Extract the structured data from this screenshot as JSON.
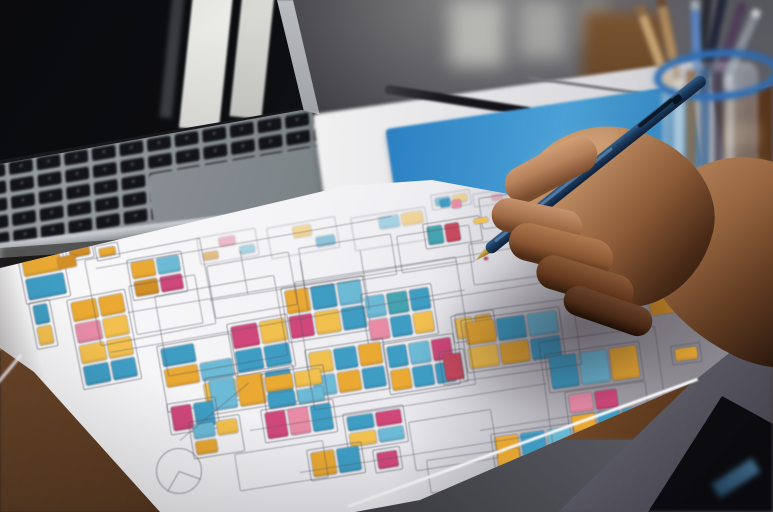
{
  "scene": {
    "description": "Photograph: a designer's hand holding a navy pen, sketching colorful app wireframes on a large paper sheet; laptop, white notepad with black pen, blue notebook and a glass cup of pencils on a wooden desk; blurred dark wall with window light behind",
    "objects": [
      "laptop",
      "keyboard",
      "trackpad",
      "white-notepad",
      "black-pen",
      "blue-notebook",
      "pencil-cup",
      "colored-pencils",
      "wireframe-paper",
      "hand",
      "navy-pen",
      "wooden-desk"
    ]
  },
  "palette": {
    "y1": "#e9a933",
    "y2": "#f2c04e",
    "y3": "#d28f26",
    "b1": "#3f9dc4",
    "b2": "#6cbad6",
    "b3": "#2d84a8",
    "p1": "#d0487a",
    "p2": "#e78ba6",
    "p3": "#c84a5f",
    "t1": "#45a4b0",
    "w": "transparent",
    "accent_notebook": "#3a8fc9",
    "accent_cup_rim": "#2f6fb5",
    "pen_navy": "#1e3e62",
    "pen_gold": "#c9a23f",
    "paper": "#f2f2f5"
  },
  "laptop": {
    "key_rows": 5,
    "key_cols": 14
  },
  "cards": [
    {
      "x": 16,
      "y": 252,
      "w": 46,
      "h": 54,
      "rot": -11,
      "rows": [
        [
          "y1"
        ],
        [
          "b1"
        ]
      ]
    },
    {
      "x": 64,
      "y": 245,
      "w": 28,
      "h": 18,
      "rot": -11,
      "rows": [
        [
          "y3"
        ]
      ]
    },
    {
      "x": 94,
      "y": 246,
      "w": 24,
      "h": 16,
      "rot": -11,
      "rows": [
        [
          "y1"
        ]
      ]
    },
    {
      "x": 28,
      "y": 303,
      "w": 22,
      "h": 48,
      "rot": -11,
      "rows": [
        [
          "b1"
        ],
        [
          "y2"
        ]
      ]
    },
    {
      "x": 66,
      "y": 300,
      "w": 60,
      "h": 92,
      "rot": -11,
      "rows": [
        [
          "y1",
          "y1"
        ],
        [
          "p2",
          "y2"
        ],
        [
          "y2",
          "y2"
        ],
        [
          "b1",
          "b1"
        ]
      ]
    },
    {
      "x": 126,
      "y": 260,
      "w": 56,
      "h": 42,
      "rot": -10,
      "rows": [
        [
          "y1",
          "b2"
        ],
        [
          "y3",
          "p1"
        ]
      ]
    },
    {
      "x": 156,
      "y": 346,
      "w": 76,
      "h": 68,
      "rot": -10,
      "rows": [
        [
          "b1",
          "w"
        ],
        [
          "y1",
          "b2"
        ],
        [
          "w",
          "y2"
        ]
      ]
    },
    {
      "x": 226,
      "y": 324,
      "w": 62,
      "h": 54,
      "rot": -10,
      "rows": [
        [
          "p1",
          "y2"
        ],
        [
          "b1",
          "b1"
        ]
      ]
    },
    {
      "x": 280,
      "y": 288,
      "w": 84,
      "h": 56,
      "rot": -9,
      "rows": [
        [
          "y1",
          "b1",
          "b2"
        ],
        [
          "p1",
          "y2",
          "b1"
        ]
      ]
    },
    {
      "x": 360,
      "y": 294,
      "w": 72,
      "h": 52,
      "rot": -9,
      "rows": [
        [
          "b2",
          "t1",
          "b1"
        ],
        [
          "p2",
          "b1",
          "y2"
        ]
      ]
    },
    {
      "x": 304,
      "y": 350,
      "w": 80,
      "h": 52,
      "rot": -9,
      "rows": [
        [
          "y2",
          "b1",
          "y1"
        ],
        [
          "b2",
          "y1",
          "b1"
        ]
      ]
    },
    {
      "x": 382,
      "y": 344,
      "w": 72,
      "h": 52,
      "rot": -9,
      "rows": [
        [
          "b1",
          "b2",
          "p1"
        ],
        [
          "y1",
          "b1",
          "b1"
        ]
      ]
    },
    {
      "x": 438,
      "y": 352,
      "w": 26,
      "h": 34,
      "rot": -9,
      "rows": [
        [
          "p3"
        ]
      ]
    },
    {
      "x": 450,
      "y": 316,
      "w": 44,
      "h": 28,
      "rot": -9,
      "rows": [
        [
          "y2",
          "y1"
        ]
      ]
    },
    {
      "x": 422,
      "y": 224,
      "w": 58,
      "h": 26,
      "rot": -9,
      "rows": [
        [
          "t1",
          "p3",
          "w"
        ]
      ]
    },
    {
      "x": 204,
      "y": 378,
      "w": 90,
      "h": 38,
      "rot": -9,
      "rows": [
        [
          "b2",
          "y1",
          "b1"
        ]
      ]
    },
    {
      "x": 166,
      "y": 404,
      "w": 50,
      "h": 32,
      "rot": -9,
      "rows": [
        [
          "p1",
          "b1"
        ]
      ]
    },
    {
      "x": 188,
      "y": 422,
      "w": 52,
      "h": 38,
      "rot": -9,
      "rows": [
        [
          "b2",
          "y2"
        ],
        [
          "y1",
          "w"
        ]
      ]
    },
    {
      "x": 260,
      "y": 374,
      "w": 64,
      "h": 40,
      "rot": -9,
      "rows": [
        [
          "y1",
          "y2"
        ],
        [
          "b1",
          "b2"
        ]
      ]
    },
    {
      "x": 260,
      "y": 410,
      "w": 74,
      "h": 34,
      "rot": -9,
      "rows": [
        [
          "p1",
          "p2",
          "b1"
        ]
      ]
    },
    {
      "x": 342,
      "y": 414,
      "w": 62,
      "h": 38,
      "rot": -9,
      "rows": [
        [
          "b1",
          "p1"
        ],
        [
          "y2",
          "b2"
        ]
      ]
    },
    {
      "x": 306,
      "y": 450,
      "w": 56,
      "h": 32,
      "rot": -9,
      "rows": [
        [
          "y1",
          "b1"
        ]
      ]
    },
    {
      "x": 372,
      "y": 450,
      "w": 28,
      "h": 24,
      "rot": -9,
      "rows": [
        [
          "p1"
        ]
      ]
    },
    {
      "x": 460,
      "y": 320,
      "w": 100,
      "h": 54,
      "rot": -8,
      "rows": [
        [
          "y1",
          "b1",
          "b2"
        ],
        [
          "y2",
          "y1",
          "b1"
        ]
      ]
    },
    {
      "x": 544,
      "y": 354,
      "w": 96,
      "h": 40,
      "rot": -8,
      "rows": [
        [
          "b1",
          "b2",
          "y1"
        ]
      ]
    },
    {
      "x": 564,
      "y": 392,
      "w": 82,
      "h": 46,
      "rot": -8,
      "rows": [
        [
          "p2",
          "p1",
          "w"
        ],
        [
          "y1",
          "b1",
          "b1"
        ]
      ]
    },
    {
      "x": 490,
      "y": 434,
      "w": 84,
      "h": 38,
      "rot": -8,
      "rows": [
        [
          "y1",
          "b1",
          "b2"
        ]
      ]
    },
    {
      "x": 670,
      "y": 346,
      "w": 30,
      "h": 20,
      "rot": -8,
      "rows": [
        [
          "y1"
        ]
      ]
    },
    {
      "x": 196,
      "y": 238,
      "w": 60,
      "h": 28,
      "rot": -10,
      "faint": true,
      "rows": [
        [
          "w",
          "p2",
          "w"
        ],
        [
          "y3",
          "w",
          "b2"
        ]
      ]
    },
    {
      "x": 266,
      "y": 228,
      "w": 70,
      "h": 32,
      "rot": -10,
      "faint": true,
      "rows": [
        [
          "w",
          "y2",
          "w"
        ],
        [
          "w",
          "w",
          "b1"
        ]
      ]
    },
    {
      "x": 350,
      "y": 218,
      "w": 76,
      "h": 34,
      "rot": -9,
      "faint": true,
      "rows": [
        [
          "w",
          "b2",
          "y2"
        ],
        [
          "w",
          "w",
          "w"
        ]
      ]
    },
    {
      "x": 430,
      "y": 195,
      "w": 40,
      "h": 16,
      "rot": -9,
      "faint": true,
      "rows": [
        [
          "b1",
          "y2"
        ]
      ]
    },
    {
      "x": 472,
      "y": 194,
      "w": 34,
      "h": 14,
      "rot": -9,
      "faint": true,
      "rows": [
        [
          "w",
          "p2"
        ]
      ]
    },
    {
      "x": 506,
      "y": 220,
      "w": 58,
      "h": 28,
      "rot": -8,
      "faint": true,
      "rows": [
        [
          "w",
          "b2",
          "w"
        ]
      ]
    },
    {
      "x": 558,
      "y": 258,
      "w": 68,
      "h": 34,
      "rot": -8,
      "faint": true,
      "rows": [
        [
          "w",
          "y2",
          "b1"
        ]
      ]
    }
  ],
  "blocks": [
    {
      "x": 440,
      "y": 199,
      "w": 10,
      "h": 8,
      "rot": -9,
      "c": "b1"
    },
    {
      "x": 452,
      "y": 200,
      "w": 9,
      "h": 8,
      "rot": -9,
      "c": "p2"
    },
    {
      "x": 474,
      "y": 218,
      "w": 14,
      "h": 5,
      "rot": -9,
      "c": "y2"
    },
    {
      "x": 484,
      "y": 257,
      "w": 4,
      "h": 3,
      "rot": 0,
      "c": "p3"
    },
    {
      "x": 58,
      "y": 256,
      "w": 18,
      "h": 12,
      "rot": -11,
      "c": "y3"
    },
    {
      "x": 650,
      "y": 298,
      "w": 24,
      "h": 16,
      "rot": -8,
      "c": "y3"
    }
  ],
  "outlines": [
    {
      "x": 128,
      "y": 286,
      "w": 68,
      "h": 50,
      "rot": -10
    },
    {
      "x": 206,
      "y": 266,
      "w": 84,
      "h": 54,
      "rot": -10
    },
    {
      "x": 298,
      "y": 248,
      "w": 94,
      "h": 42,
      "rot": -9
    },
    {
      "x": 396,
      "y": 236,
      "w": 74,
      "h": 38,
      "rot": -9
    },
    {
      "x": 468,
      "y": 244,
      "w": 82,
      "h": 42,
      "rot": -8
    },
    {
      "x": 154,
      "y": 296,
      "w": 122,
      "h": 82,
      "rot": -10
    },
    {
      "x": 294,
      "y": 282,
      "w": 164,
      "h": 130,
      "rot": -9
    },
    {
      "x": 454,
      "y": 314,
      "w": 120,
      "h": 68,
      "rot": -8
    },
    {
      "x": 408,
      "y": 422,
      "w": 84,
      "h": 50,
      "rot": -9
    },
    {
      "x": 234,
      "y": 454,
      "w": 90,
      "h": 38,
      "rot": -9
    },
    {
      "x": 426,
      "y": 460,
      "w": 94,
      "h": 34,
      "rot": -8
    },
    {
      "x": 84,
      "y": 260,
      "w": 118,
      "h": 88,
      "rot": -11
    },
    {
      "x": 538,
      "y": 342,
      "w": 118,
      "h": 106,
      "rot": -8
    },
    {
      "x": 478,
      "y": 198,
      "w": 58,
      "h": 32,
      "rot": -8
    },
    {
      "x": 520,
      "y": 470,
      "w": 84,
      "h": 28,
      "rot": -8
    }
  ],
  "lines": [
    {
      "x": 96,
      "y": 268,
      "len": 300,
      "rot": -10
    },
    {
      "x": 128,
      "y": 312,
      "len": 420,
      "rot": -9.5
    },
    {
      "x": 110,
      "y": 352,
      "len": 360,
      "rot": -10
    },
    {
      "x": 210,
      "y": 300,
      "len": 250,
      "rot": -9
    },
    {
      "x": 250,
      "y": 430,
      "len": 300,
      "rot": -9
    },
    {
      "x": 300,
      "y": 472,
      "len": 260,
      "rot": -9
    },
    {
      "x": 430,
      "y": 300,
      "len": 180,
      "rot": -9
    },
    {
      "x": 360,
      "y": 250,
      "len": 60,
      "rot": 81
    },
    {
      "x": 300,
      "y": 260,
      "len": 50,
      "rot": 81
    },
    {
      "x": 240,
      "y": 250,
      "len": 44,
      "rot": 80
    },
    {
      "x": 480,
      "y": 430,
      "len": 140,
      "rot": -9
    },
    {
      "x": 180,
      "y": 440,
      "len": 90,
      "rot": -40
    }
  ],
  "doodle_circle": {
    "x": 156,
    "y": 448,
    "d": 46
  }
}
